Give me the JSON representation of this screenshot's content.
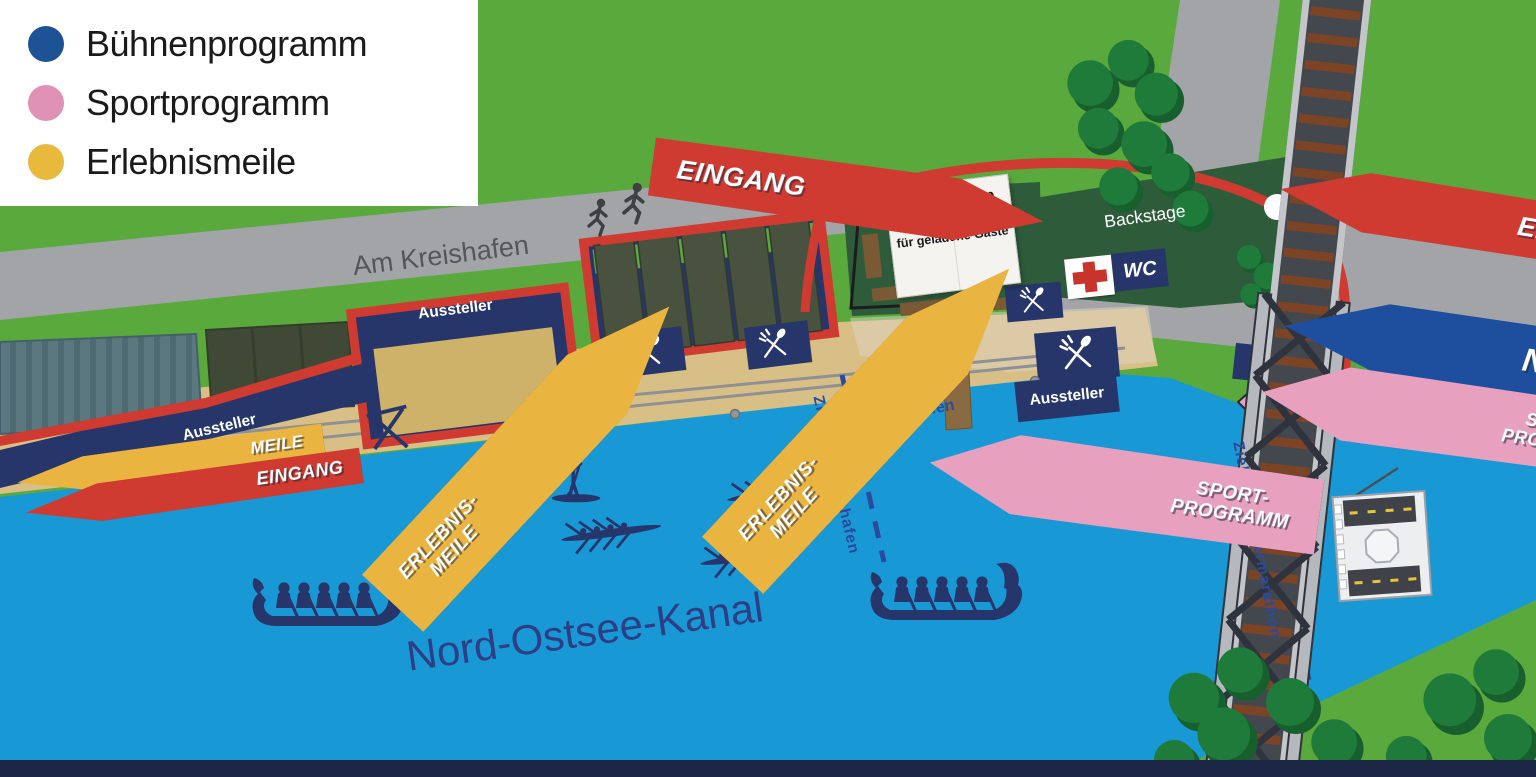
{
  "legend": {
    "items": [
      {
        "label": "Bühnenprogramm",
        "color": "#1d5394"
      },
      {
        "label": "Sportprogramm",
        "color": "#e091b6"
      },
      {
        "label": "Erlebnismeile",
        "color": "#e8b93c"
      }
    ]
  },
  "labels": {
    "street": "Am Kreishafen",
    "water": "Nord-Ostsee-Kanal",
    "backstage": "Backstage",
    "lounge_title": "SH Netz Cup Lounge",
    "lounge_subtitle": "für geladene Gäste",
    "wc": "WC",
    "aussteller_left": "Aussteller",
    "aussteller_center": "Aussteller",
    "aussteller_right": "Aussteller",
    "sportarena_line1": "Sportarena",
    "sportarena_line2": "Kreishafen",
    "finish_kreishafen": "Ziellinie Kreishafen",
    "finish_rudermarathon": "Ziellinie Rudermarathon"
  },
  "signs": {
    "entrance_left": "EINGANG",
    "entrance_right": "EINGANG",
    "entrance_meile_line1": "MEILE",
    "entrance_meile_line2": "EINGANG",
    "ndr_stage": "NDR BÜHNE",
    "sport_center_line1": "SPORT-",
    "sport_center_line2": "PROGRAMM",
    "sport_right_line1": "SPORT-",
    "sport_right_line2": "PROGRAMM",
    "erlebnis_center_line1": "ERLEBNIS-",
    "erlebnis_center_line2": "MEILE",
    "erlebnis_left_line1": "ERLEBNIS-",
    "erlebnis_left_line2": "MEILE"
  },
  "colors": {
    "water": "#1899d6",
    "grass": "#5aa93d",
    "road": "#a2a4a7",
    "navy": "#26366b",
    "signal_red": "#cf3b30",
    "stage_blue": "#1d4f9e",
    "pink": "#e8a0bf",
    "yellow": "#eab440",
    "area_green": "#2e5c3b",
    "quay": "#d8bf86",
    "finish_label": "#2b4a9b",
    "first_aid_red": "#c8332b"
  },
  "icons": {
    "first_aid": "red-cross-icon",
    "food": "crossed-cutlery-icon",
    "runners": "runner-icon",
    "boats": [
      "dragon-boat",
      "rowing-shell",
      "stand-up-paddler"
    ],
    "ferry": "transporter-gondola"
  }
}
